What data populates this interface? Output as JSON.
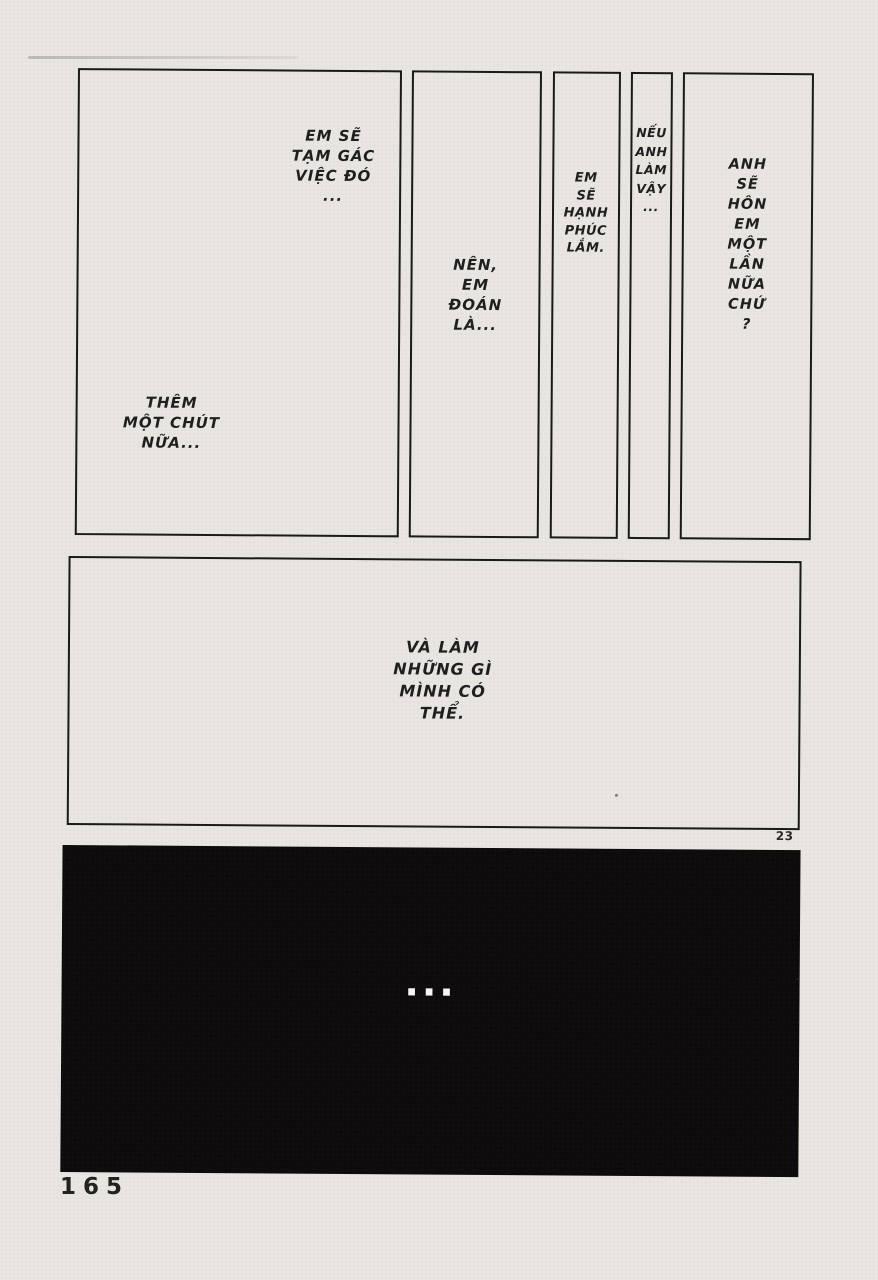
{
  "page": {
    "page_number": "165",
    "corner_number": "23",
    "colors": {
      "paper": "#e9e6e1",
      "ink": "#1f1f1f",
      "panel_border": "#1a1a1a",
      "black_panel": "#0d0b0c",
      "ellipsis_white": "#f5f5f5"
    }
  },
  "panels": {
    "p1": {
      "bubble_top": "EM SẼ\nTẠM GÁC\nVIỆC ĐÓ\n...",
      "bubble_bottom": "THÊM\nMỘT CHÚT\nNỮA..."
    },
    "p2": {
      "text": "NÊN,\nEM\nĐOÁN\nLÀ..."
    },
    "p3": {
      "text": "EM\nSẼ\nHẠNH\nPHÚC\nLẮM."
    },
    "p4": {
      "text": "NẾU\nANH\nLÀM\nVẬY\n..."
    },
    "p5": {
      "text": "ANH\nSẼ\nHÔN\nEM\nMỘT\nLẦN\nNỮA\nCHỨ\n?"
    },
    "p6": {
      "text": "VÀ LÀM\nNHỮNG GÌ\nMÌNH CÓ\nTHỂ."
    },
    "p7": {
      "text": "..."
    }
  }
}
